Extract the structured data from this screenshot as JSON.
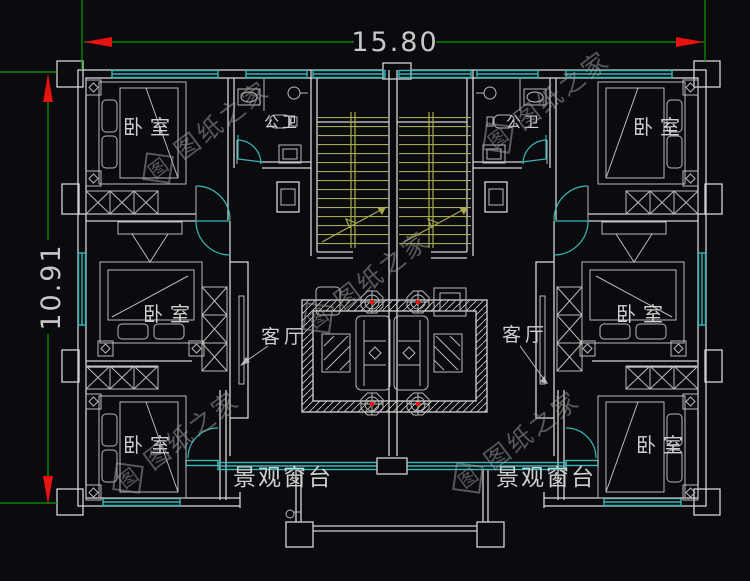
{
  "dimensions": {
    "width": "15.80",
    "height": "10.91"
  },
  "labels": {
    "bedroom": "卧室",
    "bathroom": "公卫",
    "living_room": "客厅",
    "bay_window": "景观窗台"
  },
  "watermark": {
    "text": "图纸之家",
    "logo_char": "图"
  },
  "colors": {
    "background": "#0b0b0f",
    "walls": "#d4d4d4",
    "furniture": "#b9b9b9",
    "windows": "#35b8b8",
    "stairs": "#a8a84e",
    "dimension_lines": "#00a000",
    "dimension_arrows": "#e81212",
    "text": "#cfcfcf",
    "watermark": "#9a9a9a"
  }
}
